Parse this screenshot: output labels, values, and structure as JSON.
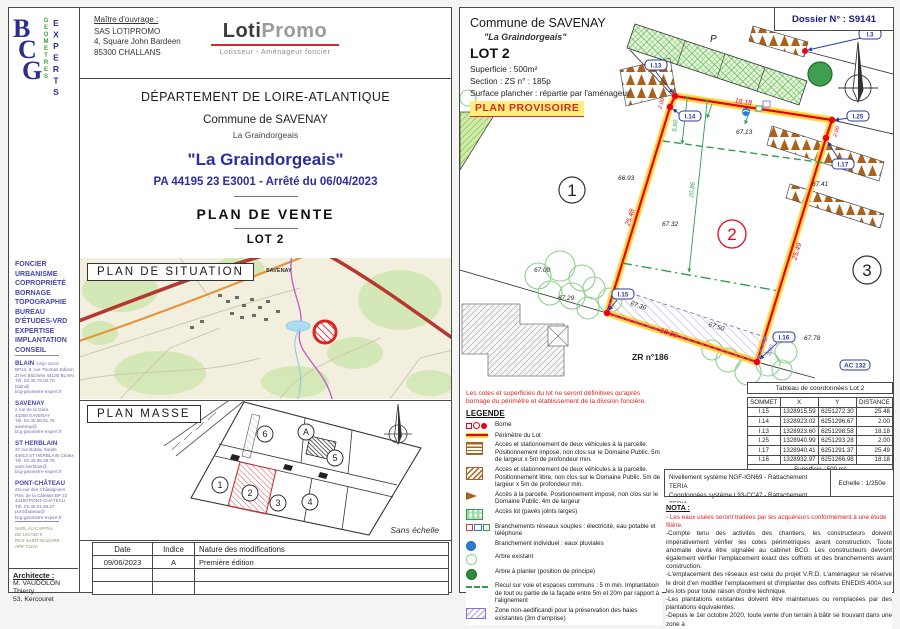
{
  "colors": {
    "accent_blue": "#2d2d9b",
    "lot_red": "#e8001c",
    "lot_yellow": "#ffd633",
    "green": "#2f9e4f",
    "purple": "#8a6fd6",
    "brown": "#a9611c",
    "navy": "#1b1b7e"
  },
  "left_page": {
    "logo": {
      "b": "B",
      "c": "C",
      "g": "G",
      "word_green": "GEOMETRES",
      "word_blue": "EXPERTS"
    },
    "maitre": {
      "label": "Maître d'ouvrage :",
      "line1": "SAS LOTIPROMO",
      "line2": "4, Square John Bardeen",
      "line3": "85300 CHALLANS"
    },
    "lotipromo": {
      "loti": "Loti",
      "promo": "Promo",
      "tagline": "Lotisseur - Aménageur foncier"
    },
    "title": {
      "departement": "DÉPARTEMENT DE LOIRE-ATLANTIQUE",
      "commune": "Commune de SAVENAY",
      "lieu": "La Graindorgeais",
      "project": "\"La Graindorgeais\"",
      "permit": "PA 44195 23 E3001 - Arrêté du 06/04/2023",
      "plan_title": "PLAN  DE  VENTE",
      "lot": "LOT 2"
    },
    "situation": {
      "label": "PLAN  DE  SITUATION",
      "town": "SAVENAY"
    },
    "masse": {
      "label": "PLAN  MASSE",
      "sans_echelle": "Sans échelle",
      "lots": {
        "l1": "1",
        "l2": "2",
        "l3": "3",
        "l4": "4",
        "l5": "5",
        "l6": "6",
        "la": "A"
      }
    },
    "revisions": {
      "headers": [
        "Date",
        "Indice",
        "Nature des modifications"
      ],
      "rows": [
        [
          "09/06/2023",
          "A",
          "Première édition"
        ],
        [
          "",
          "",
          ""
        ],
        [
          "",
          "",
          ""
        ]
      ]
    },
    "sidebar": {
      "services": [
        "FONCIER",
        "URBANISME",
        "COPROPRIÉTÉ",
        "BORNAGE",
        "TOPOGRAPHIE",
        "BUREAU",
        "D'ÉTUDES-VRD",
        "EXPERTISE",
        "IMPLANTATION",
        "CONSEIL"
      ],
      "offices": [
        {
          "city": "BLAIN",
          "tag": "Siège social",
          "lines": [
            "BP14, 9, rue Thomas Edison",
            "ZI les Blûchets 44130 BLAIN",
            "Tél. 02.40.79.02.70",
            "blain@",
            "bcg-geometre-expert.fr"
          ]
        },
        {
          "city": "SAVENAY",
          "tag": "",
          "lines": [
            "2 rue de la Gare",
            "44260 SAVENAY",
            "Tél. 02.40.56.91.75",
            "savenay@",
            "bcg-geometre-expert.fr"
          ]
        },
        {
          "city": "ST HERBLAIN",
          "tag": "",
          "lines": [
            "37 rue Bobby Sands",
            "44813 ST HERBLAIN Cédex",
            "Tél. 02.40.95.39.75",
            "saint.herblain@",
            "bcg-geometre-expert.fr"
          ]
        },
        {
          "city": "PONT-CHÂTEAU",
          "tag": "",
          "lines": [
            "ZIa rue des Châtaigniers",
            "Parc de la Câtelais BP 22",
            "44160 PONT-CHÂTEAU",
            "Tél. 02.40.01.60.27",
            "pontchateau@",
            "bcg-geometre-expert.fr"
          ]
        }
      ],
      "legal": [
        "SARL AU CAPITAL",
        "DE 194 000 €",
        "RCS SAINT-NAZAIRE",
        "APE 7112A"
      ],
      "architect": {
        "label": "Architecte :",
        "line1": "M. VAUDOLON Thierry",
        "line2": "53, Kercouret"
      }
    }
  },
  "right_page": {
    "header": {
      "commune": "Commune de SAVENAY",
      "lieu": "\"La Graindorgeais\"",
      "lot": "LOT 2",
      "superficie": "Superficie :  500m²",
      "section": "Section : ZS     n° : 185p",
      "surface": "Surface plancher : répartie par l'aménageur",
      "plan_provisoire": "PLAN PROVISOIRE",
      "dossier": "Dossier N° : S9141"
    },
    "plan": {
      "bornes": {
        "i3": "I.3",
        "i13": "I.13",
        "i14": "I.14",
        "i25": "I.25",
        "i17": "I.17",
        "i15": "I.15",
        "i16": "I.16"
      },
      "dims": {
        "top": "18.18",
        "left": "25.48",
        "right": "25.49",
        "bottom": "18.18",
        "jog_left": "2.00",
        "jog_right": "2.00",
        "recul_depth": "20.86",
        "recul_front": "5.60",
        "zone_width": "3.00"
      },
      "elevations": {
        "lot1": "66.93",
        "top": "67.13",
        "center": "67.32",
        "right": "67.41",
        "bottom_right": "67.78",
        "trees_a": "67.00",
        "trees_b": "67.29",
        "hatch_a": "67.36",
        "hatch_b": "67.50"
      },
      "labels": {
        "lot1": "1",
        "lot2": "2",
        "lot3": "3",
        "parking": "P",
        "parcel": "ZR n°186",
        "ac": "AC 132"
      }
    },
    "legend": {
      "note": "Les cotes et superficies du lot ne seront définitives qu'après bornage du périmètre et établissement de la division foncière.",
      "title": "LEGENDE",
      "items": [
        "Borne",
        "Périmètre du Lot",
        "Accès et stationnement de deux véhicules à la parcelle. Positionnement imposé, non clos sur le Domaine Public. 5m de largeur x 5m de profondeur min.",
        "Accès et stationnement de deux véhicules à la parcelle. Positionnement libre, non clos sur le Domaine Public. 5m de largeur x 5m de profondeur min.",
        "Accès à la parcelle. Positionnement imposé, non clos sur le Domaine Public. 4m de largeur",
        "Accès lot (pavés joints larges)",
        "Branchements réseaux souples : électricité, eau potable et téléphone",
        "Branchement individuel : eaux pluviales",
        "Arbre existant",
        "Arbre à planter (position de principe)",
        "Recul sur voie et espaces communs : 5 m min. Implantation de tout ou partie de la façade entre 5m et 20m par rapport à l'alignement",
        "Zone non-aedificandi pour la préservation des haies existantes (3m d'emprise)"
      ]
    },
    "coord_table": {
      "title": "Tableau de coordonnées Lot 2",
      "headers": [
        "SOMMET",
        "X",
        "Y",
        "DISTANCE"
      ],
      "rows": [
        [
          "I.15",
          "1328915.59",
          "6251272.30",
          "25.48"
        ],
        [
          "I.14",
          "1328923.02",
          "6251296.67",
          "2.00"
        ],
        [
          "I.13",
          "1328923.60",
          "6251298.58",
          "18.18"
        ],
        [
          "I.25",
          "1328940.99",
          "6251293.28",
          "2.00"
        ],
        [
          "I.17",
          "1328940.41",
          "6251291.37",
          "25.49"
        ],
        [
          "I.16",
          "1328932.97",
          "6251266.98",
          "18.18"
        ]
      ],
      "footer": "Superficie : 500 m²"
    },
    "refbox": {
      "line1": "Nivellement système NGF-IGN69 - Rattachement TERIA",
      "line2": "Coordonnées système L93-CC47 - Rattachement TERIA",
      "echelle": "Echelle : 1/250e"
    },
    "nota": {
      "title": "NOTA :",
      "red_line": "- Les eaux usées seront traitées par les acquéreurs conformément à une étude filière.",
      "paragraphs": [
        "-Compte tenu des activités des chantiers, les constructeurs doivent impérativement vérifier les cotes périmétriques avant construction. Toute anomalie devra être signalée au cabinet BCG. Les constructeurs devront également vérifier l'emplacement exact des coffrets et des branchements avant construction.",
        "-L'emplacement des réseaux est celui du projet V.R.D. L'aménageur se réserve le droit d'en modifier l'emplacement et d'implanter des coffrets ENEDIS 400A sur les lots pour toute raison d'ordre technique.",
        "-Les plantations existantes doivent être maintenues ou remplacées par des plantations équivalentes.",
        "-Depuis le 1er octobre 2020, toute vente d'un terrain à bâtir se trouvant dans une zone à"
      ]
    }
  }
}
